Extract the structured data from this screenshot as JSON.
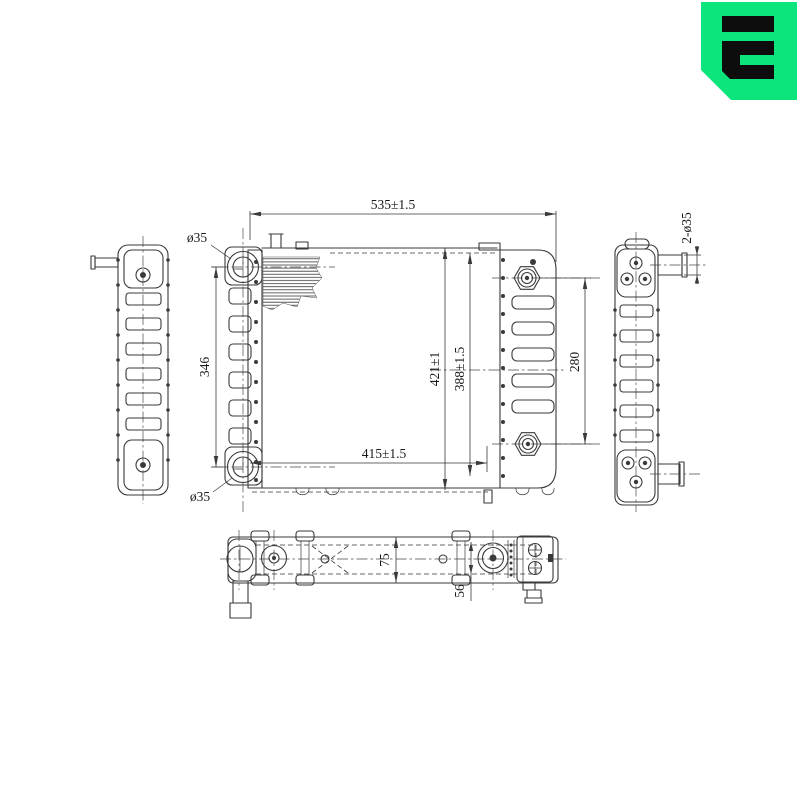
{
  "drawing": {
    "type": "radiator-engineering-drawing",
    "background": "#ffffff",
    "line_color": "#3a3a3a",
    "dimensions": {
      "overall_width": "535±1.5",
      "mount_width": "415±1.5",
      "overall_height": "421±1",
      "core_height": "388±1.5",
      "bracket_height": "346",
      "boss_spacing": "280",
      "top_port_dia": "ø35",
      "bottom_port_dia": "ø35",
      "pipe_dia": "2-ø35",
      "depth": "75",
      "tab_offset": "56"
    }
  },
  "logo": {
    "green": "#0ce57c",
    "glyph": "#0d0d0d"
  }
}
